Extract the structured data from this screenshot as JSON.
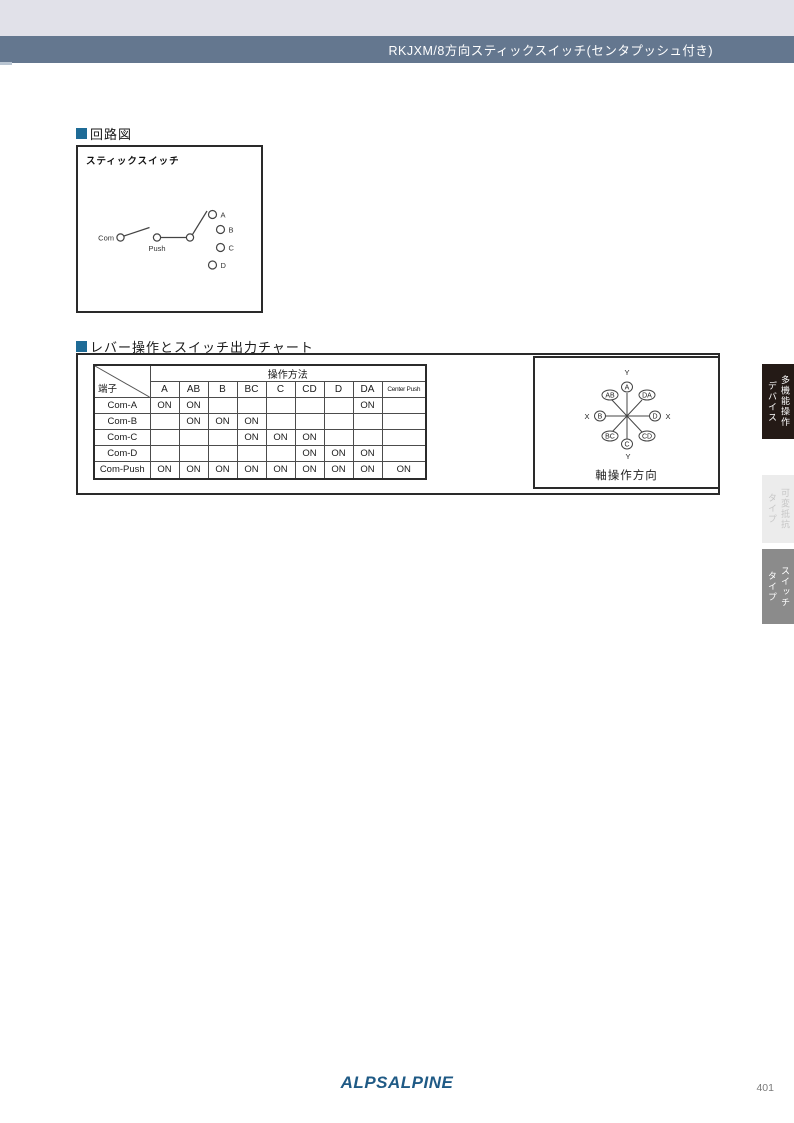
{
  "header": {
    "title": "RKJXM/8方向スティックスイッチ(センタプッシュ付き)",
    "title_bar_color": "#64778f",
    "top_bar_color": "#e1e1e9",
    "accent_color": "#b9c5d2"
  },
  "circuit_section": {
    "heading": "回路図",
    "marker_color": "#1e6b96",
    "box_title": "スティックスイッチ",
    "labels": {
      "com": "Com",
      "push": "Push",
      "a": "A",
      "b": "B",
      "c": "C",
      "d": "D"
    }
  },
  "chart_section": {
    "heading": "レバー操作とスイッチ出力チャート"
  },
  "table": {
    "corner_label": "端子",
    "group_header": "操作方法",
    "columns": [
      "A",
      "AB",
      "B",
      "BC",
      "C",
      "CD",
      "D",
      "DA",
      "Center Push"
    ],
    "rows": [
      {
        "label": "Com-A",
        "values": [
          "ON",
          "ON",
          "",
          "",
          "",
          "",
          "",
          "ON",
          ""
        ]
      },
      {
        "label": "Com-B",
        "values": [
          "",
          "ON",
          "ON",
          "ON",
          "",
          "",
          "",
          "",
          ""
        ]
      },
      {
        "label": "Com-C",
        "values": [
          "",
          "",
          "",
          "ON",
          "ON",
          "ON",
          "",
          "",
          ""
        ]
      },
      {
        "label": "Com-D",
        "values": [
          "",
          "",
          "",
          "",
          "",
          "ON",
          "ON",
          "ON",
          ""
        ]
      },
      {
        "label": "Com-Push",
        "values": [
          "ON",
          "ON",
          "ON",
          "ON",
          "ON",
          "ON",
          "ON",
          "ON",
          "ON"
        ]
      }
    ]
  },
  "axis_diagram": {
    "caption": "軸操作方向",
    "labels": {
      "y_top": "Y",
      "y_bottom": "Y",
      "x_left": "X",
      "x_right": "X",
      "dir_a": "A",
      "dir_ab": "AB",
      "dir_b": "B",
      "dir_bc": "BC",
      "dir_c": "C",
      "dir_cd": "CD",
      "dir_d": "D",
      "dir_da": "DA"
    }
  },
  "side_tabs": [
    {
      "label": "多機能操作デバイス",
      "line1": "多機能操作",
      "line2": "デバイス",
      "bg": "#241a16",
      "fg": "#ffffff"
    },
    {
      "label": "可変抵抗タイプ",
      "line1": "可変抵抗",
      "line2": "タイプ",
      "bg": "#ececec",
      "fg": "#c6c6c6"
    },
    {
      "label": "スイッチタイプ",
      "line1": "スイッチ",
      "line2": "タイプ",
      "bg": "#8b8b8b",
      "fg": "#ffffff"
    }
  ],
  "footer": {
    "logo_text": "ALPSALPINE",
    "logo_color": "#1f5a85",
    "page_number": "401"
  }
}
